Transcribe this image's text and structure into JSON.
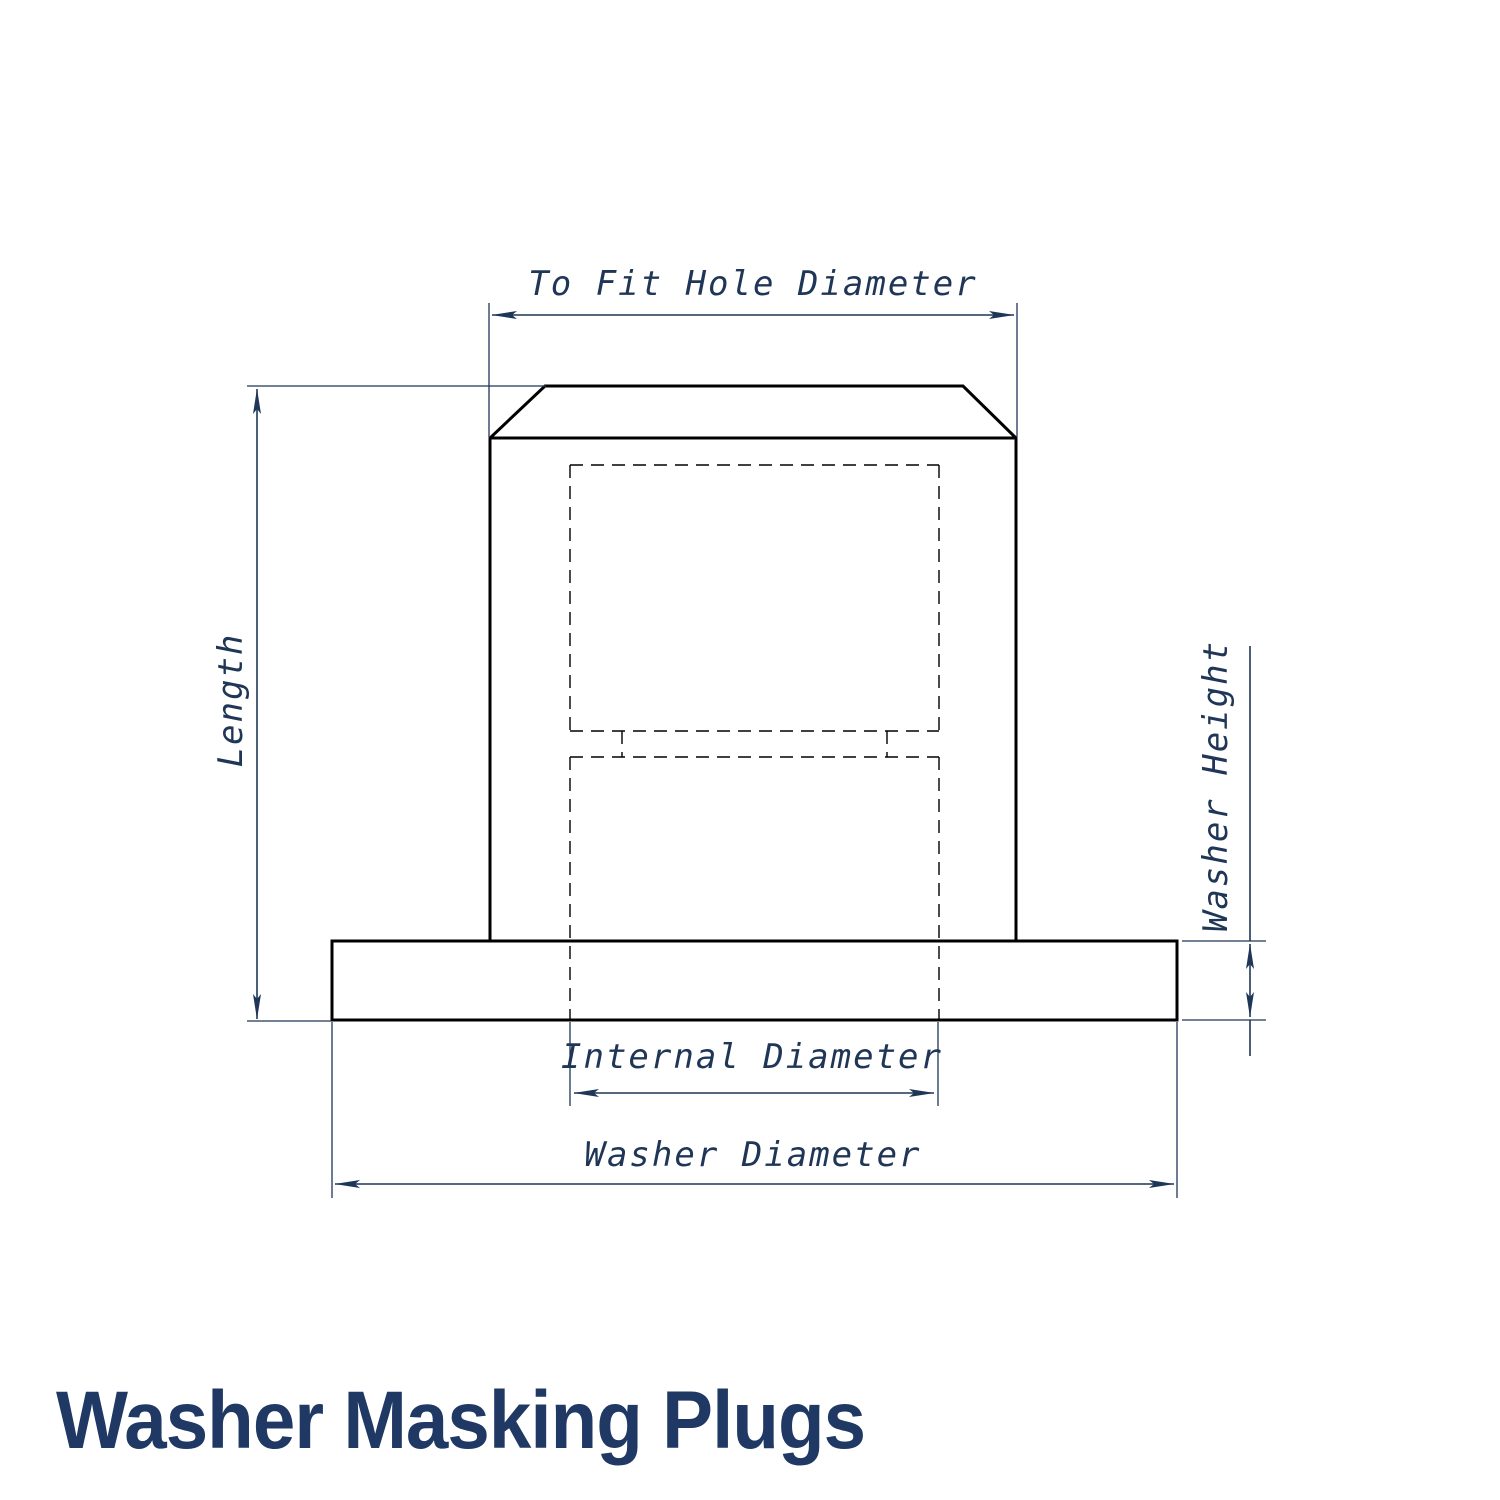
{
  "title": "Washer Masking Plugs",
  "diagram": {
    "type": "technical-drawing",
    "subject": "washer masking plug cross-section",
    "labels": {
      "to_fit_hole_diameter": "To Fit Hole Diameter",
      "length": "Length",
      "washer_height": "Washer Height",
      "internal_diameter": "Internal Diameter",
      "washer_diameter": "Washer Diameter"
    },
    "colors": {
      "dimension_lines": "#1f3656",
      "object_outline": "#000000",
      "title_text": "#1f3864",
      "background": "#ffffff"
    },
    "line_styles": {
      "object": "solid thick",
      "hidden_cavity": "dashed thin",
      "dimension": "solid thin with filled arrowheads"
    }
  }
}
